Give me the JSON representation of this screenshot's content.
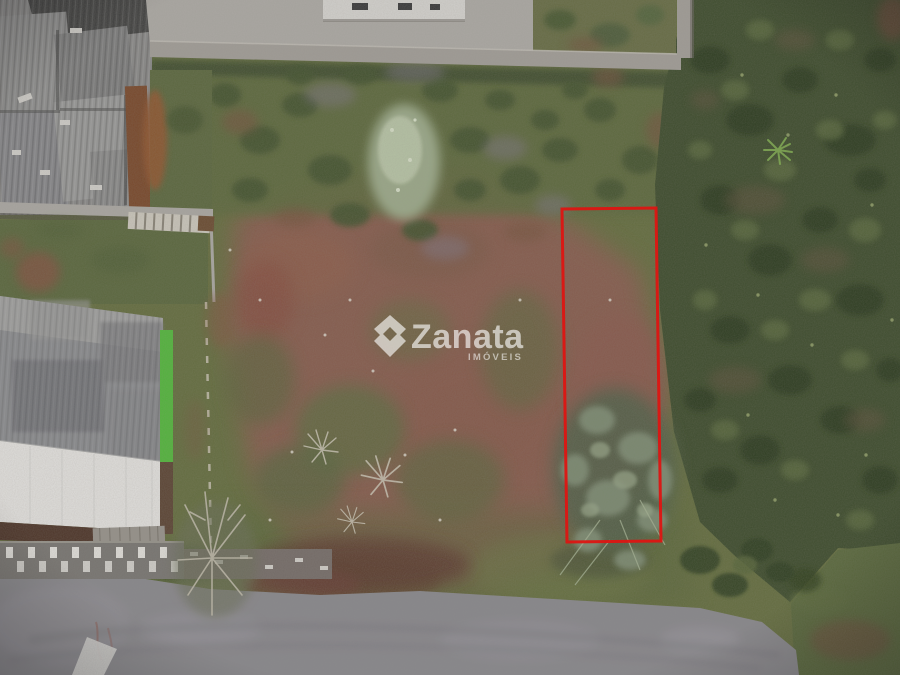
{
  "image": {
    "alt": "Aerial drone photo of a vacant land plot; a red outline marks a narrow rectangular lot between buildings with metal roofs, scrub vegetation and a gravel road"
  },
  "watermark": {
    "brand": "Zanata",
    "tagline": "IMÓVEIS",
    "icon": "zanata-double-chevron-icon"
  },
  "colors": {
    "boundary_red": "#dd1512",
    "watermark_white": "#ffffff",
    "grass_base": "#67713f",
    "dirt_brown": "#8d5f4f",
    "road_gray": "#8e8c90",
    "scrub_green": "#3f4e2c",
    "wall_concrete": "#a7a39b",
    "roof_white": "#eceae6",
    "roof_gray": "#8f9092",
    "green_wall": "#55bd3c"
  }
}
